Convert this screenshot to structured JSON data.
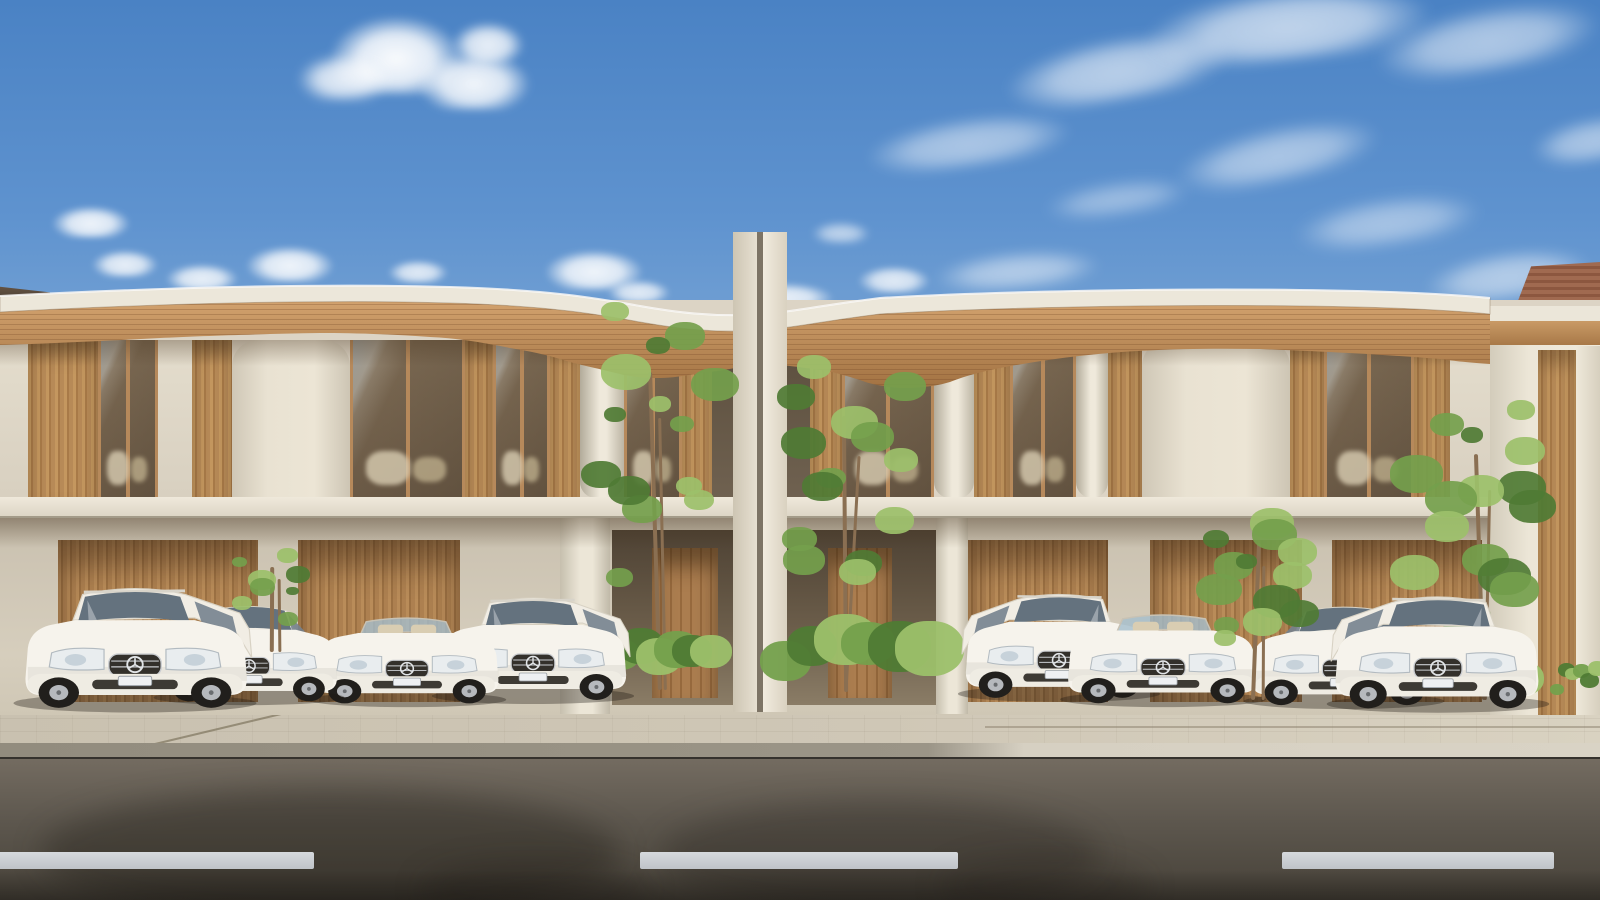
{
  "scene": {
    "description": "Photorealistic architectural rendering: modern two-storey cream residence with curved timber-soffit roof, wood slat screens and glass bays; eight white luxury cars parked in carports behind a paved sidewalk and asphalt road under a blue sky with scattered clouds.",
    "palette": {
      "sky_top": "#4a82c4",
      "sky_horizon": "#d8e2ea",
      "wall_cream": "#e6dfd0",
      "wood": "#b78a57",
      "soffit_wood_light": "#cf9f6b",
      "soffit_wood_dark": "#a87948",
      "glass": "#6a5a46",
      "sidewalk": "#cfc7b6",
      "curb_shaded": "#9b9587",
      "road_top": "#746c61",
      "road_bottom": "#474239",
      "lane_dash": "#d0d4d8",
      "car_body": "#f6f3ec",
      "foliage_light": "#9cc06a",
      "foliage_mid": "#74a04c",
      "foliage_dark": "#4f7b34",
      "neighbor_tile_roof": "#96604a"
    },
    "clouds": [
      {
        "x": 330,
        "y": 16,
        "w": 132,
        "h": 78,
        "op": 0.97,
        "b": 4,
        "rot": 0
      },
      {
        "x": 298,
        "y": 54,
        "w": 92,
        "h": 46,
        "op": 0.85,
        "b": 5,
        "rot": 0
      },
      {
        "x": 418,
        "y": 52,
        "w": 112,
        "h": 58,
        "op": 0.92,
        "b": 4,
        "rot": 0
      },
      {
        "x": 452,
        "y": 22,
        "w": 72,
        "h": 42,
        "op": 0.88,
        "b": 4,
        "rot": 0
      },
      {
        "x": 52,
        "y": 206,
        "w": 78,
        "h": 32,
        "op": 0.9,
        "b": 3,
        "rot": 0
      },
      {
        "x": 92,
        "y": 250,
        "w": 66,
        "h": 27,
        "op": 0.85,
        "b": 3,
        "rot": 0
      },
      {
        "x": 166,
        "y": 264,
        "w": 72,
        "h": 27,
        "op": 0.85,
        "b": 3,
        "rot": 0
      },
      {
        "x": 246,
        "y": 246,
        "w": 88,
        "h": 36,
        "op": 0.9,
        "b": 3,
        "rot": 0
      },
      {
        "x": 388,
        "y": 260,
        "w": 60,
        "h": 23,
        "op": 0.8,
        "b": 3,
        "rot": 0
      },
      {
        "x": 545,
        "y": 250,
        "w": 98,
        "h": 40,
        "op": 0.9,
        "b": 3,
        "rot": 0
      },
      {
        "x": 608,
        "y": 280,
        "w": 62,
        "h": 23,
        "op": 0.8,
        "b": 3,
        "rot": 0
      },
      {
        "x": 735,
        "y": 283,
        "w": 98,
        "h": 27,
        "op": 0.85,
        "b": 3,
        "rot": 0
      },
      {
        "x": 858,
        "y": 266,
        "w": 72,
        "h": 27,
        "op": 0.8,
        "b": 3,
        "rot": 0
      },
      {
        "x": 812,
        "y": 222,
        "w": 58,
        "h": 21,
        "op": 0.6,
        "b": 4,
        "rot": 0
      },
      {
        "x": 1412,
        "y": 296,
        "w": 48,
        "h": 17,
        "op": 0.8,
        "b": 2,
        "rot": 0
      },
      {
        "x": 866,
        "y": 118,
        "w": 205,
        "h": 48,
        "op": 0.5,
        "b": 6,
        "rot": -8
      },
      {
        "x": 1005,
        "y": 38,
        "w": 225,
        "h": 62,
        "op": 0.6,
        "b": 6,
        "rot": -10
      },
      {
        "x": 1145,
        "y": -12,
        "w": 285,
        "h": 72,
        "op": 0.65,
        "b": 6,
        "rot": -6
      },
      {
        "x": 1375,
        "y": 8,
        "w": 225,
        "h": 62,
        "op": 0.55,
        "b": 7,
        "rot": -10
      },
      {
        "x": 1175,
        "y": 128,
        "w": 205,
        "h": 52,
        "op": 0.5,
        "b": 7,
        "rot": -12
      },
      {
        "x": 1295,
        "y": 198,
        "w": 185,
        "h": 46,
        "op": 0.45,
        "b": 7,
        "rot": -8
      },
      {
        "x": 935,
        "y": 252,
        "w": 165,
        "h": 36,
        "op": 0.5,
        "b": 6,
        "rot": -5
      },
      {
        "x": 1425,
        "y": 252,
        "w": 165,
        "h": 46,
        "op": 0.5,
        "b": 6,
        "rot": -8
      },
      {
        "x": 1532,
        "y": 118,
        "w": 125,
        "h": 42,
        "op": 0.5,
        "b": 6,
        "rot": -10
      },
      {
        "x": 1045,
        "y": 182,
        "w": 145,
        "h": 32,
        "op": 0.4,
        "b": 7,
        "rot": -8
      }
    ],
    "upper_panels": [
      {
        "x": 0,
        "w": 28,
        "type": "wall"
      },
      {
        "x": 28,
        "w": 70,
        "type": "slat"
      },
      {
        "x": 98,
        "w": 60,
        "type": "glass"
      },
      {
        "x": 158,
        "w": 34,
        "type": "wall"
      },
      {
        "x": 192,
        "w": 40,
        "type": "slat"
      },
      {
        "x": 232,
        "w": 118,
        "type": "bigwall"
      },
      {
        "x": 350,
        "w": 115,
        "type": "glassBig"
      },
      {
        "x": 465,
        "w": 28,
        "type": "slat"
      },
      {
        "x": 493,
        "w": 57,
        "type": "glass"
      },
      {
        "x": 550,
        "w": 30,
        "type": "slat"
      },
      {
        "x": 580,
        "w": 44,
        "type": "column"
      },
      {
        "x": 624,
        "w": 58,
        "type": "glass"
      },
      {
        "x": 682,
        "w": 30,
        "type": "slat"
      },
      {
        "x": 712,
        "w": 23,
        "type": "recess"
      },
      {
        "x": 785,
        "w": 25,
        "type": "recess"
      },
      {
        "x": 810,
        "w": 32,
        "type": "slat"
      },
      {
        "x": 842,
        "w": 92,
        "type": "glassBig"
      },
      {
        "x": 934,
        "w": 40,
        "type": "column"
      },
      {
        "x": 974,
        "w": 36,
        "type": "slat"
      },
      {
        "x": 1010,
        "w": 66,
        "type": "glass"
      },
      {
        "x": 1076,
        "w": 32,
        "type": "column"
      },
      {
        "x": 1108,
        "w": 34,
        "type": "slat"
      },
      {
        "x": 1142,
        "w": 148,
        "type": "bigwall"
      },
      {
        "x": 1290,
        "w": 34,
        "type": "slat"
      },
      {
        "x": 1324,
        "w": 90,
        "type": "glassBig"
      },
      {
        "x": 1414,
        "w": 36,
        "type": "slat"
      },
      {
        "x": 1450,
        "w": 40,
        "type": "wall"
      }
    ],
    "ground": {
      "screens": [
        {
          "x": 58,
          "w": 200
        },
        {
          "x": 298,
          "w": 162
        },
        {
          "x": 968,
          "w": 140
        },
        {
          "x": 1150,
          "w": 152
        },
        {
          "x": 1332,
          "w": 150
        }
      ],
      "dark_bays": [
        {
          "x": 612,
          "w": 122
        },
        {
          "x": 786,
          "w": 150
        }
      ],
      "doors": [
        {
          "x": 652,
          "w": 66
        },
        {
          "x": 828,
          "w": 64
        }
      ],
      "pillars": [
        {
          "x": 560,
          "w": 50
        },
        {
          "x": 936,
          "w": 32
        },
        {
          "x": 1546,
          "w": 54
        }
      ]
    },
    "trees": [
      {
        "cx": 272,
        "top": 548,
        "bottom": 652,
        "spread": 84,
        "seed": 1,
        "front": true
      },
      {
        "cx": 655,
        "top": 302,
        "bottom": 690,
        "spread": 150,
        "seed": 3,
        "front": false
      },
      {
        "cx": 845,
        "top": 355,
        "bottom": 692,
        "spread": 152,
        "seed": 4,
        "front": false
      },
      {
        "cx": 1256,
        "top": 508,
        "bottom": 700,
        "spread": 140,
        "seed": 5,
        "front": true
      },
      {
        "cx": 1480,
        "top": 400,
        "bottom": 700,
        "spread": 160,
        "seed": 6,
        "front": false
      }
    ],
    "bushes": [
      {
        "x": 180,
        "y": 640,
        "w": 110,
        "h": 48
      },
      {
        "x": 420,
        "y": 645,
        "w": 120,
        "h": 50
      },
      {
        "x": 600,
        "y": 615,
        "w": 120,
        "h": 68
      },
      {
        "x": 760,
        "y": 620,
        "w": 180,
        "h": 66
      },
      {
        "x": 1180,
        "y": 640,
        "w": 140,
        "h": 55
      },
      {
        "x": 1390,
        "y": 648,
        "w": 150,
        "h": 50
      },
      {
        "x": 1550,
        "y": 625,
        "w": 50,
        "h": 75
      },
      {
        "x": 1060,
        "y": 662,
        "w": 90,
        "h": 36
      }
    ],
    "cars": [
      {
        "kind": "wagon",
        "x": 4,
        "w": 262,
        "h": 152,
        "bottom": 716,
        "z": 18,
        "flip": false
      },
      {
        "kind": "sedan",
        "x": 146,
        "w": 206,
        "h": 124,
        "bottom": 708,
        "z": 17,
        "flip": false
      },
      {
        "kind": "convertible",
        "x": 300,
        "w": 214,
        "h": 122,
        "bottom": 710,
        "z": 16,
        "flip": false
      },
      {
        "kind": "wagon",
        "x": 424,
        "w": 218,
        "h": 130,
        "bottom": 707,
        "z": 15,
        "flip": false
      },
      {
        "kind": "wagon",
        "x": 950,
        "w": 218,
        "h": 132,
        "bottom": 705,
        "z": 15,
        "flip": true
      },
      {
        "kind": "convertible",
        "x": 1052,
        "w": 222,
        "h": 126,
        "bottom": 710,
        "z": 16,
        "flip": true
      },
      {
        "kind": "sedan",
        "x": 1236,
        "w": 216,
        "h": 128,
        "bottom": 712,
        "z": 17,
        "flip": true
      },
      {
        "kind": "wagon",
        "x": 1318,
        "w": 240,
        "h": 142,
        "bottom": 716,
        "z": 18,
        "flip": true
      }
    ],
    "road": {
      "dashes": [
        {
          "x": -12,
          "w": 326
        },
        {
          "x": 640,
          "w": 318
        },
        {
          "x": 1282,
          "w": 272
        }
      ],
      "shadows": [
        {
          "x": 40,
          "y": 788,
          "w": 580,
          "h": 130,
          "op": 0.32
        },
        {
          "x": 660,
          "y": 800,
          "w": 440,
          "h": 110,
          "op": 0.25
        },
        {
          "x": 420,
          "y": 860,
          "w": 230,
          "h": 60,
          "op": 0.22
        },
        {
          "x": 940,
          "y": 856,
          "w": 210,
          "h": 60,
          "op": 0.2
        }
      ]
    }
  }
}
